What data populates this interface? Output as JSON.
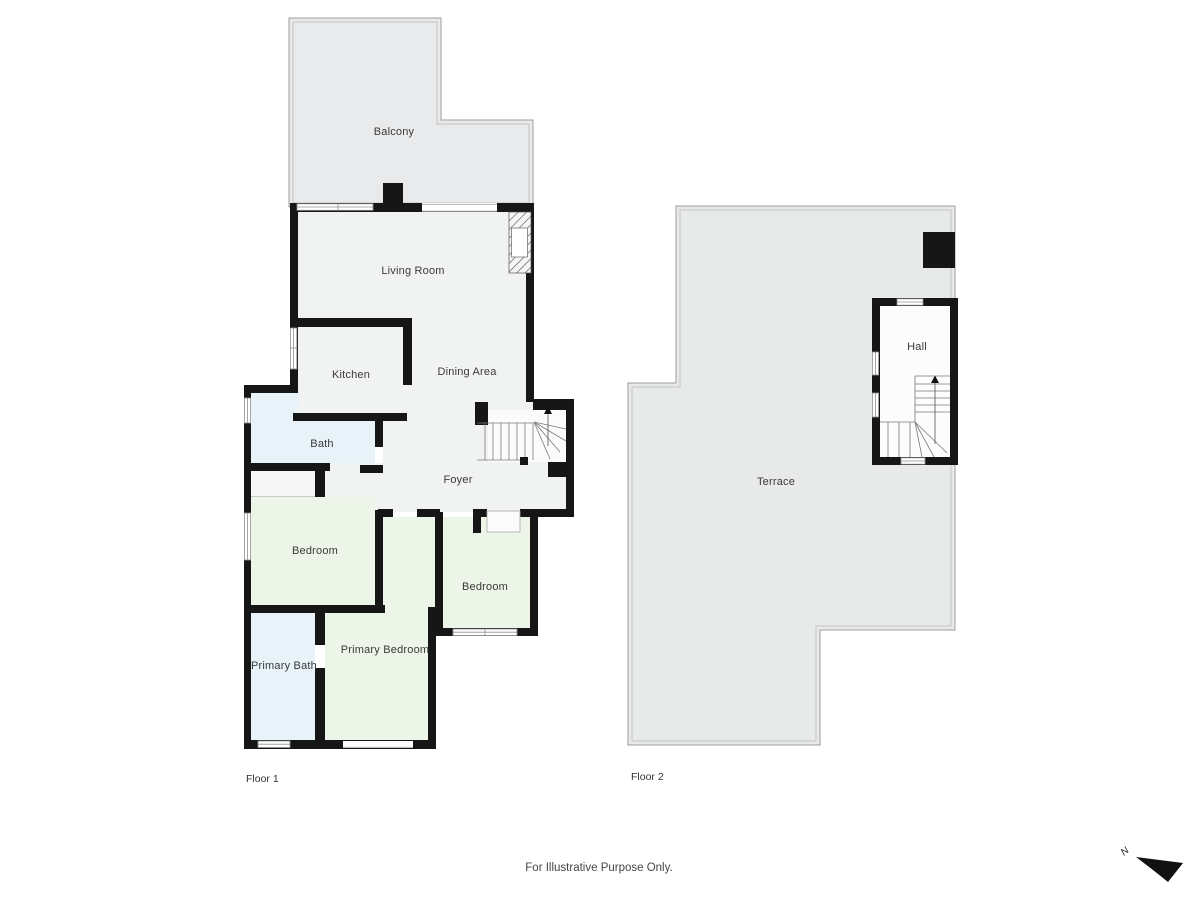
{
  "page": {
    "disclaimer": "For Illustrative Purpose Only."
  },
  "colors": {
    "wall": "#161616",
    "outdoor_fill": "#e8e9ea",
    "interior_fill": "#f1f2f2",
    "bath_fill": "#e7f2f9",
    "bedroom_fill": "#edf4e8",
    "hall_fill": "#fcfcfc",
    "outline": "#9e9e9e"
  },
  "floor1": {
    "label": "Floor 1",
    "rooms": [
      {
        "name": "balcony",
        "label": "Balcony"
      },
      {
        "name": "living-room",
        "label": "Living Room"
      },
      {
        "name": "kitchen",
        "label": "Kitchen"
      },
      {
        "name": "dining-area",
        "label": "Dining Area"
      },
      {
        "name": "bath",
        "label": "Bath"
      },
      {
        "name": "foyer",
        "label": "Foyer"
      },
      {
        "name": "bedroom-left",
        "label": "Bedroom"
      },
      {
        "name": "bedroom-right",
        "label": "Bedroom"
      },
      {
        "name": "primary-bath",
        "label": "Primary Bath"
      },
      {
        "name": "primary-bedroom",
        "label": "Primary Bedroom"
      }
    ]
  },
  "floor2": {
    "label": "Floor 2",
    "rooms": [
      {
        "name": "terrace",
        "label": "Terrace"
      },
      {
        "name": "hall",
        "label": "Hall"
      }
    ]
  },
  "compass": {
    "north_label": "N"
  }
}
